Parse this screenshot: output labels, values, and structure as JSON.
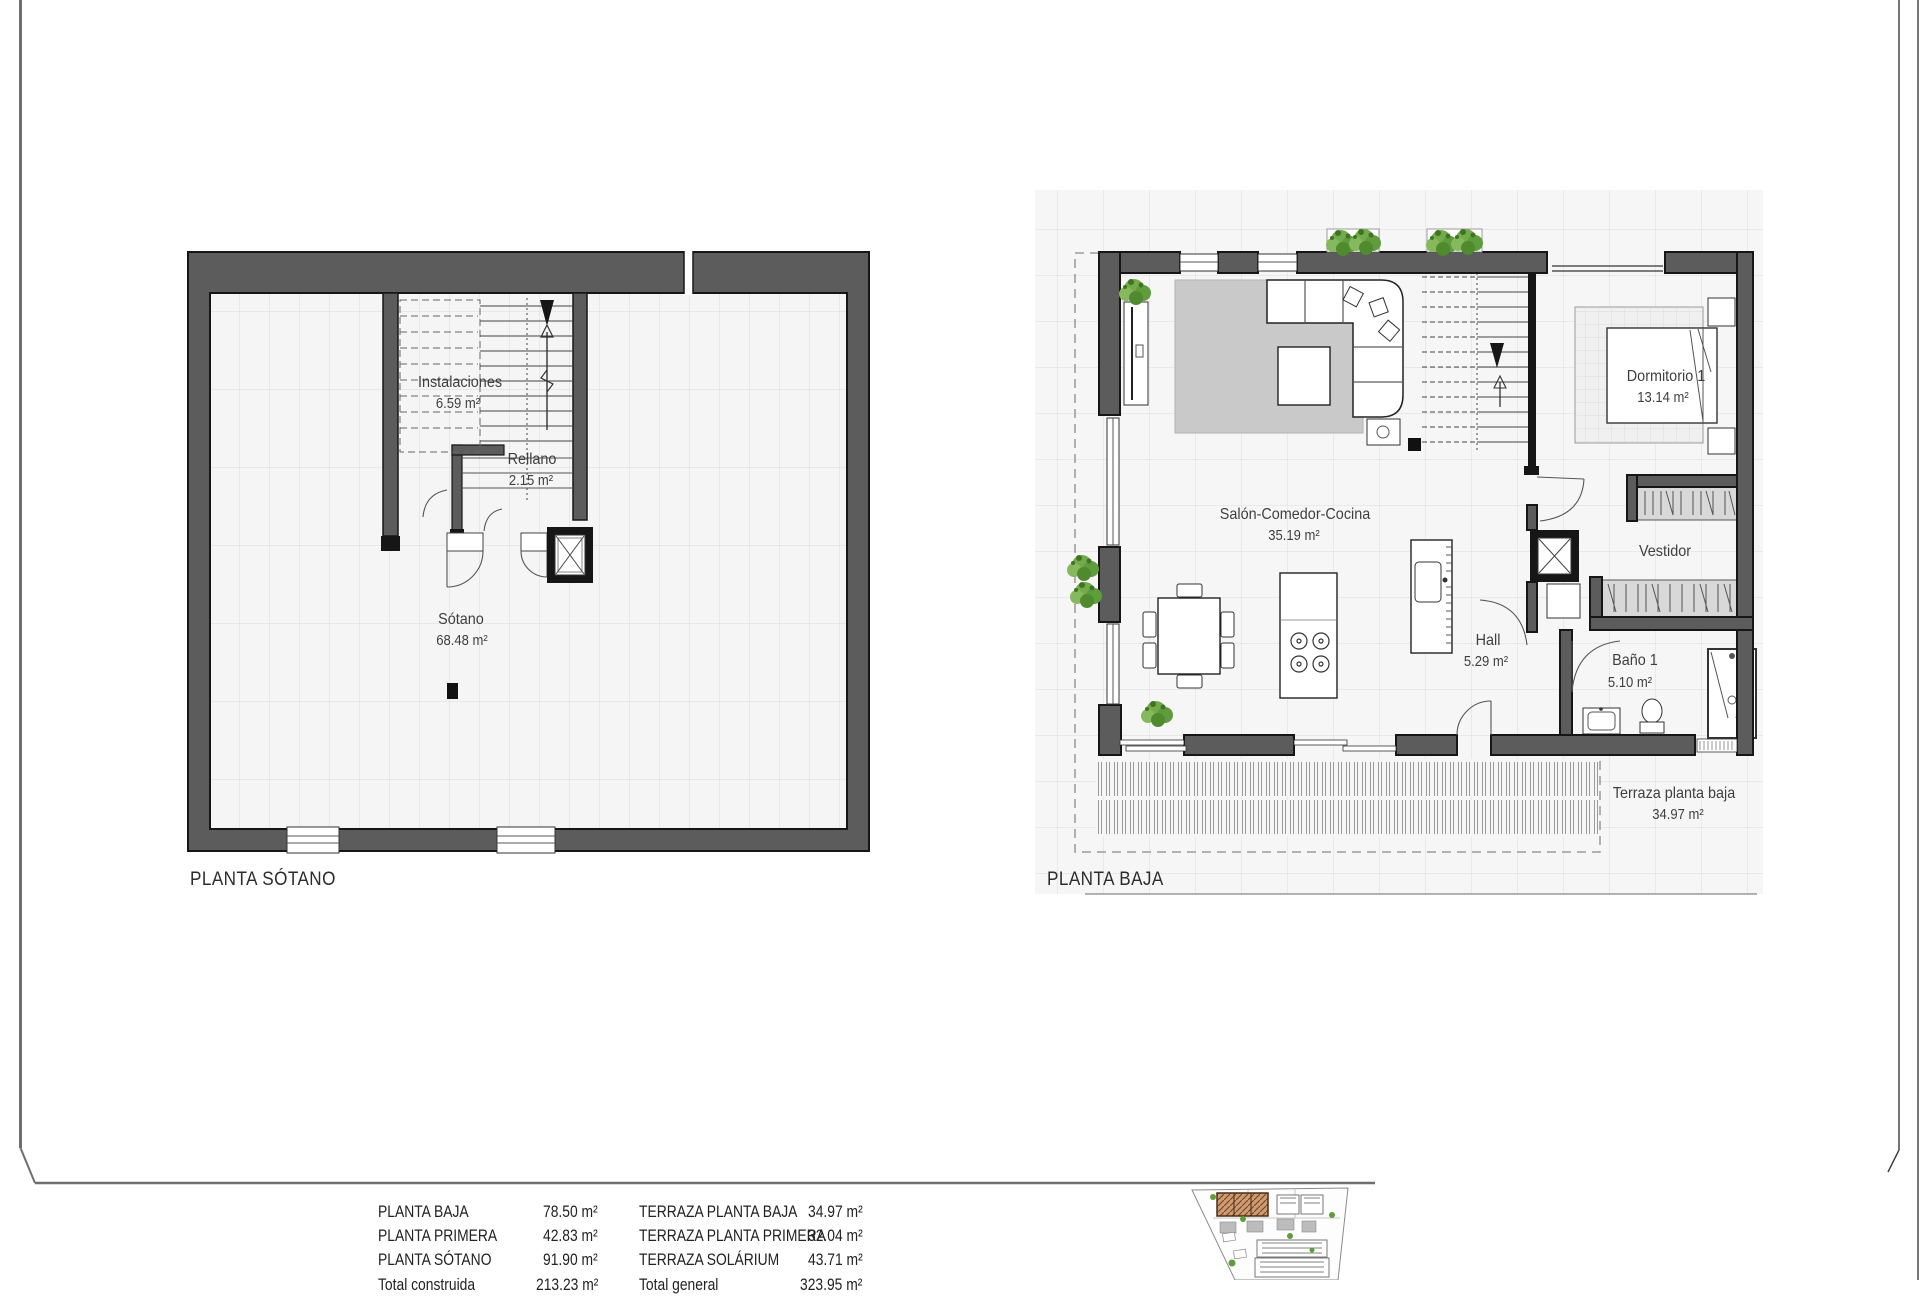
{
  "sheet_title": "Floor plan sheet",
  "palette": {
    "wall_fill": "#5c5c5c",
    "wall_edge": "#161616",
    "grid_line": "#dcdcdc",
    "floor_fill": "#f5f5f5",
    "dash_line": "#8a8a8a",
    "rug_gray": "#c9c9c9",
    "closet_gray": "#d8d8d8",
    "plant_green": "#5f9c3c",
    "site_highlight": "#cf9b72",
    "frame_gray": "#6e6e6e"
  },
  "floor_plans": {
    "sotano": {
      "caption": "PLANTA SÓTANO",
      "rooms": {
        "instalaciones": {
          "name": "Instalaciones",
          "area": "6.59 m²"
        },
        "rellano": {
          "name": "Rellano",
          "area": "2.15 m²"
        },
        "sotano": {
          "name": "Sótano",
          "area": "68.48 m²"
        }
      }
    },
    "baja": {
      "caption": "PLANTA BAJA",
      "rooms": {
        "dormitorio1": {
          "name": "Dormitorio 1",
          "area": "13.14 m²"
        },
        "salon": {
          "name": "Salón-Comedor-Cocina",
          "area": "35.19 m²"
        },
        "vestidor": {
          "name": "Vestidor"
        },
        "hall": {
          "name": "Hall",
          "area": "5.29 m²"
        },
        "bano1": {
          "name": "Baño 1",
          "area": "5.10 m²"
        },
        "terraza": {
          "name": "Terraza planta baja",
          "area": "34.97 m²"
        }
      }
    }
  },
  "summary_table": {
    "left_column": [
      {
        "label": "PLANTA BAJA",
        "value": "78.50 m²"
      },
      {
        "label": "PLANTA PRIMERA",
        "value": "42.83 m²"
      },
      {
        "label": "PLANTA SÓTANO",
        "value": "91.90 m²"
      },
      {
        "label": "Total construida",
        "value": "213.23 m²"
      }
    ],
    "right_column": [
      {
        "label": "TERRAZA PLANTA BAJA",
        "value": "34.97 m²"
      },
      {
        "label": "TERRAZA PLANTA PRIMERA",
        "value": "32.04 m²"
      },
      {
        "label": "TERRAZA SOLÁRIUM",
        "value": "43.71 m²"
      },
      {
        "label": "Total general",
        "value": "323.95 m²"
      }
    ]
  }
}
